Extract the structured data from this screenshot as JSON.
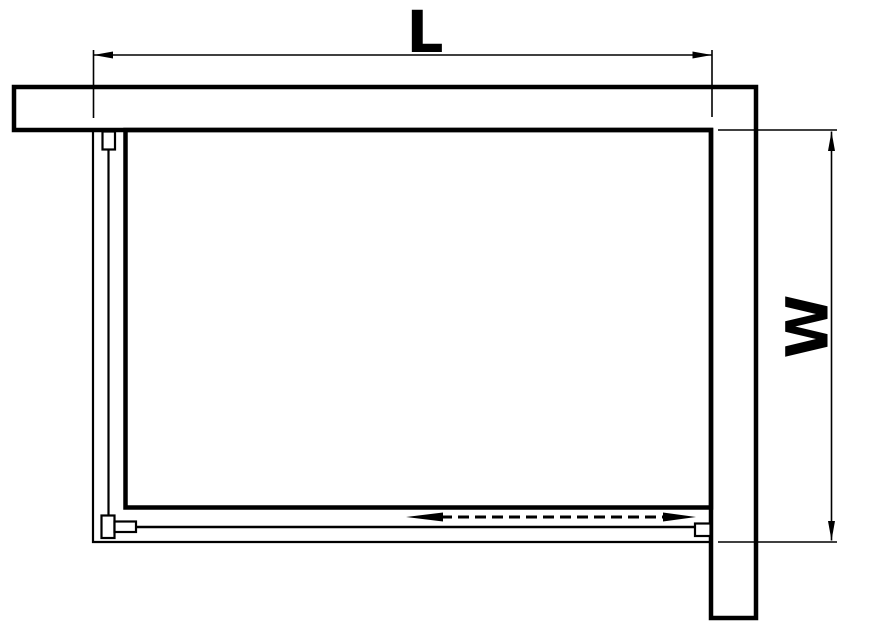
{
  "diagram": {
    "labels": {
      "length": "L",
      "width": "W"
    },
    "colors": {
      "line": "#000000",
      "background": "#ffffff"
    },
    "annotations": {
      "slide_direction": "double-headed-dashed-arrow"
    }
  }
}
